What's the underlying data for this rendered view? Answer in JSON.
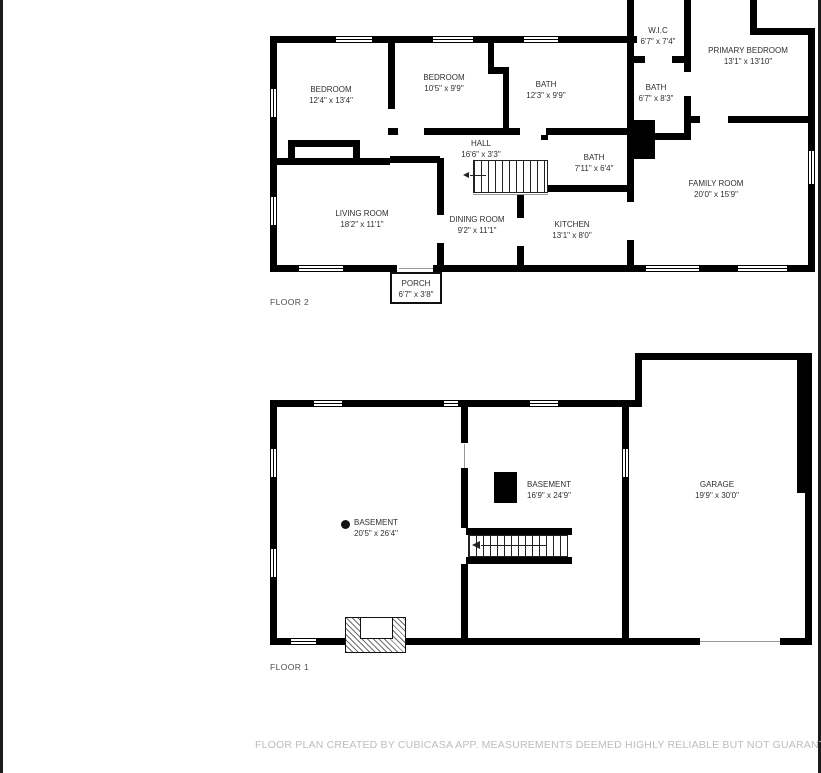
{
  "colors": {
    "walls": "#000000",
    "footer_text": "#bdbdbd",
    "label_text": "#2f2f2f"
  },
  "floor2": {
    "label": "FLOOR 2",
    "rooms": [
      {
        "name": "BEDROOM",
        "dims": "12'4\" x 13'4\""
      },
      {
        "name": "BEDROOM",
        "dims": "10'5\" x 9'9\""
      },
      {
        "name": "BATH",
        "dims": "12'3\" x 9'9\""
      },
      {
        "name": "W.I.C",
        "dims": "6'7\" x 7'4\""
      },
      {
        "name": "BATH",
        "dims": "6'7\" x 8'3\""
      },
      {
        "name": "PRIMARY BEDROOM",
        "dims": "13'1\" x 13'10\""
      },
      {
        "name": "HALL",
        "dims": "16'6\" x 3'3\""
      },
      {
        "name": "BATH",
        "dims": "7'11\" x 6'4\""
      },
      {
        "name": "FAMILY ROOM",
        "dims": "20'0\" x 15'9\""
      },
      {
        "name": "LIVING ROOM",
        "dims": "18'2\" x 11'1\""
      },
      {
        "name": "DINING ROOM",
        "dims": "9'2\" x 11'1\""
      },
      {
        "name": "KITCHEN",
        "dims": "13'1\" x 8'0\""
      },
      {
        "name": "PORCH",
        "dims": "6'7\" x 3'8\""
      }
    ]
  },
  "floor1": {
    "label": "FLOOR 1",
    "rooms": [
      {
        "name": "BASEMENT",
        "dims": "20'5\" x 26'4\""
      },
      {
        "name": "BASEMENT",
        "dims": "16'9\" x 24'9\""
      },
      {
        "name": "GARAGE",
        "dims": "19'9\" x 30'0\""
      }
    ]
  },
  "footer": {
    "text": "FLOOR PLAN CREATED BY CUBICASA APP. MEASUREMENTS DEEMED HIGHLY RELIABLE BUT NOT GUARANTEED."
  }
}
